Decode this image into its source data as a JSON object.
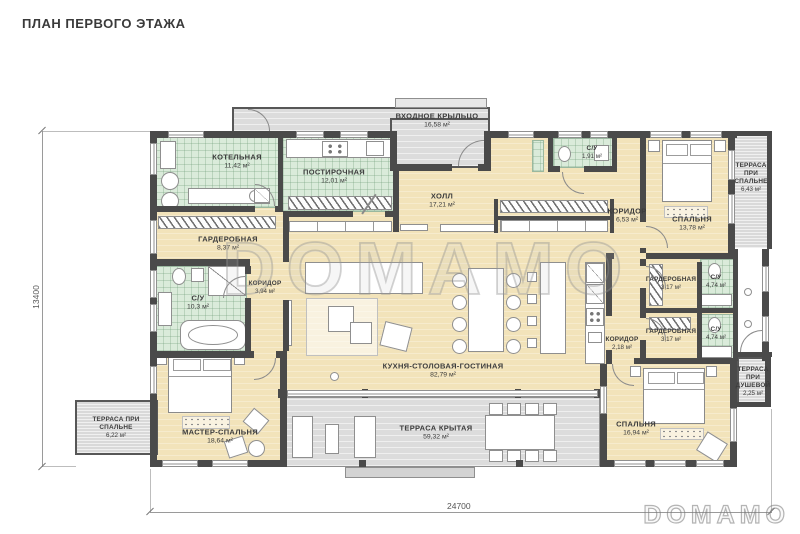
{
  "title": "ПЛАН ПЕРВОГО ЭТАЖА",
  "watermark": "DOMAMO",
  "brand_logo": "DOMAMO",
  "dimensions": {
    "bottom": "24700",
    "left": "13400"
  },
  "rooms": [
    {
      "name": "КОТЕЛЬНАЯ",
      "area": "11,42 м²"
    },
    {
      "name": "ПОСТИРОЧНАЯ",
      "area": "12,01 м²"
    },
    {
      "name": "ВХОДНОЕ КРЫЛЬЦО",
      "area": "16,58 м²"
    },
    {
      "name": "ХОЛЛ",
      "area": "17,21 м²"
    },
    {
      "name": "С/У",
      "area": "1,91 м²"
    },
    {
      "name": "КОРИДОР",
      "area": "6,53 м²"
    },
    {
      "name": "СПАЛЬНЯ",
      "area": "13,78 м²"
    },
    {
      "name": "ТЕРРАСА ПРИ СПАЛЬНЕ",
      "area": "6,43 м²"
    },
    {
      "name": "ГАРДЕРОБНАЯ",
      "area": "8,37 м²"
    },
    {
      "name": "КОРИДОР",
      "area": "3,94 м²"
    },
    {
      "name": "С/У",
      "area": "10,3 м²"
    },
    {
      "name": "ГАРДЕРОБНАЯ",
      "area": "3,17 м²"
    },
    {
      "name": "С/У",
      "area": "4,74 м²"
    },
    {
      "name": "ГАРДЕРОБНАЯ",
      "area": "3,17 м²"
    },
    {
      "name": "С/У",
      "area": "4,74 м²"
    },
    {
      "name": "КОРИДОР",
      "area": "2,18 м²"
    },
    {
      "name": "ТЕРРАСА ПРИ ДУШЕВОЙ",
      "area": "2,25 м²"
    },
    {
      "name": "КУХНЯ-СТОЛОВАЯ-ГОСТИНАЯ",
      "area": "82,79 м²"
    },
    {
      "name": "МАСТЕР-СПАЛЬНЯ",
      "area": "18,64 м²"
    },
    {
      "name": "ТЕРРАСА ПРИ СПАЛЬНЕ",
      "area": "6,22 м²"
    },
    {
      "name": "СПАЛЬНЯ",
      "area": "16,94 м²"
    },
    {
      "name": "ТЕРРАСА КРЫТАЯ",
      "area": "59,32 м²"
    }
  ]
}
